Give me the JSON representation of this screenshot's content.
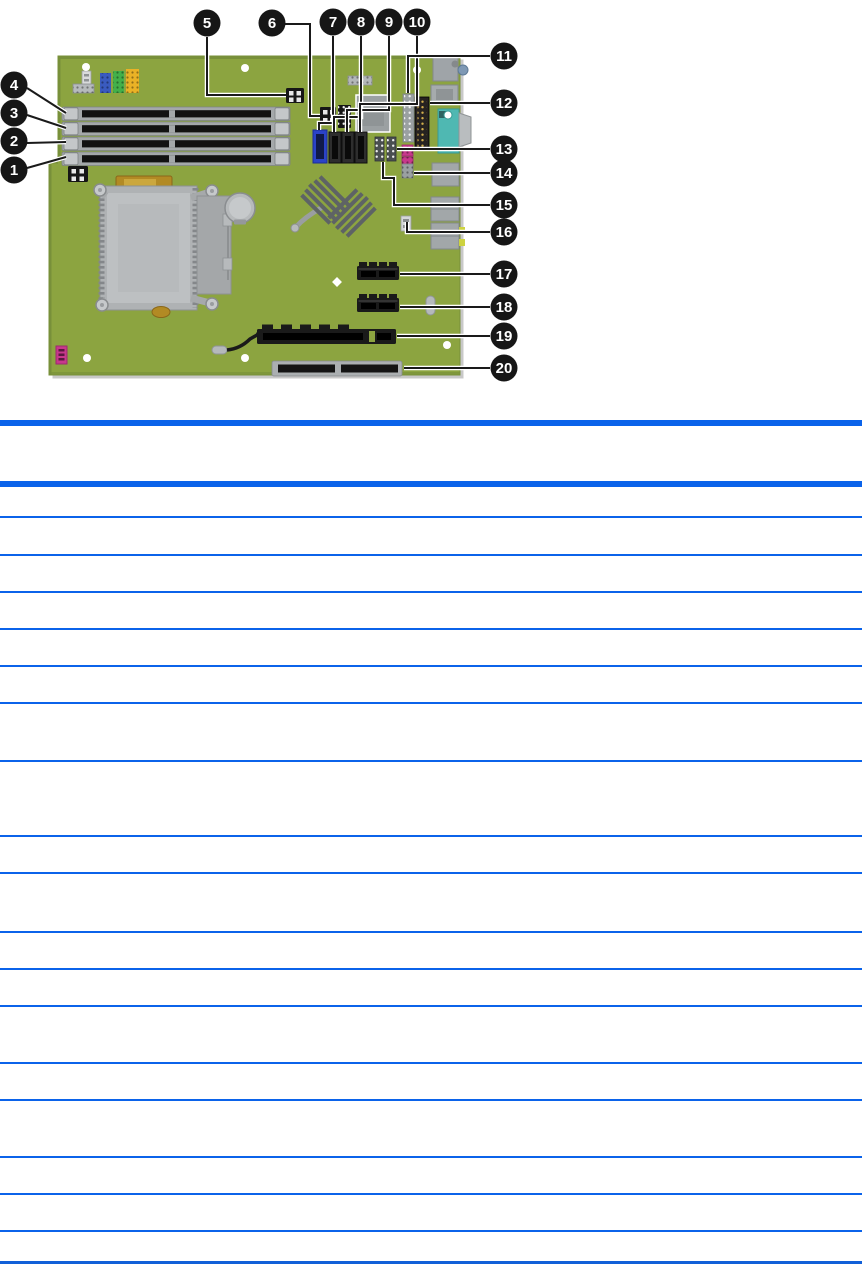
{
  "page": {
    "width": 862,
    "height": 1272,
    "background": "#ffffff"
  },
  "diagram": {
    "title": "system-board-callout-figure",
    "colors": {
      "pcb": "#8CA440",
      "pcb_edge": "#78903A",
      "board_shadow": "#C8C8C8",
      "callout_fill": "#161616",
      "callout_text": "#FFFFFF",
      "leader_line": "#1A1A1A",
      "leader_halo": "#FFFFFF",
      "slot_dark": "#1A1A1A",
      "metal": "#ABAFB1",
      "metal_light": "#C6C9CB",
      "sata_blue": "#2B43C8",
      "header_blue": "#3A5BBF",
      "header_green": "#43B04A",
      "header_yellow": "#EAB226",
      "vga_teal": "#4FB8B2",
      "pink": "#C8388C",
      "gold": "#B28A24"
    },
    "callouts": [
      {
        "label": "1",
        "cx": 14,
        "cy": 170,
        "leader": [
          [
            27,
            168
          ],
          [
            66,
            157
          ]
        ]
      },
      {
        "label": "2",
        "cx": 14,
        "cy": 141,
        "leader": [
          [
            27,
            143
          ],
          [
            66,
            142
          ]
        ]
      },
      {
        "label": "3",
        "cx": 14,
        "cy": 113,
        "leader": [
          [
            27,
            115
          ],
          [
            66,
            128
          ]
        ]
      },
      {
        "label": "4",
        "cx": 14,
        "cy": 85,
        "leader": [
          [
            27,
            88
          ],
          [
            66,
            113
          ]
        ]
      },
      {
        "label": "5",
        "cx": 207,
        "cy": 23,
        "leader": [
          [
            207,
            37
          ],
          [
            207,
            95
          ],
          [
            286,
            95
          ]
        ]
      },
      {
        "label": "6",
        "cx": 272,
        "cy": 23,
        "leader": [
          [
            285,
            24
          ],
          [
            310,
            24
          ],
          [
            310,
            116
          ],
          [
            320,
            116
          ]
        ]
      },
      {
        "label": "7",
        "cx": 333,
        "cy": 22,
        "leader": [
          [
            333,
            36
          ],
          [
            333,
            123
          ],
          [
            319,
            123
          ],
          [
            319,
            130
          ]
        ]
      },
      {
        "label": "8",
        "cx": 361,
        "cy": 22,
        "leader": [
          [
            361,
            36
          ],
          [
            361,
            117
          ],
          [
            334,
            117
          ],
          [
            334,
            132
          ]
        ]
      },
      {
        "label": "9",
        "cx": 389,
        "cy": 22,
        "leader": [
          [
            389,
            36
          ],
          [
            389,
            110
          ],
          [
            347,
            110
          ],
          [
            347,
            132
          ]
        ]
      },
      {
        "label": "10",
        "cx": 417,
        "cy": 22,
        "leader": [
          [
            417,
            36
          ],
          [
            417,
            104
          ],
          [
            360,
            104
          ],
          [
            360,
            132
          ]
        ]
      },
      {
        "label": "11",
        "cx": 504,
        "cy": 56,
        "leader": [
          [
            490,
            56
          ],
          [
            408,
            56
          ],
          [
            408,
            93
          ]
        ]
      },
      {
        "label": "12",
        "cx": 504,
        "cy": 103,
        "leader": [
          [
            490,
            103
          ],
          [
            430,
            103
          ]
        ]
      },
      {
        "label": "13",
        "cx": 504,
        "cy": 149,
        "leader": [
          [
            490,
            149
          ],
          [
            397,
            149
          ]
        ]
      },
      {
        "label": "14",
        "cx": 504,
        "cy": 173,
        "leader": [
          [
            490,
            173
          ],
          [
            414,
            173
          ]
        ]
      },
      {
        "label": "15",
        "cx": 504,
        "cy": 205,
        "leader": [
          [
            490,
            205
          ],
          [
            394,
            205
          ],
          [
            394,
            178
          ],
          [
            383,
            178
          ],
          [
            383,
            162
          ]
        ]
      },
      {
        "label": "16",
        "cx": 504,
        "cy": 232,
        "leader": [
          [
            490,
            232
          ],
          [
            407,
            232
          ],
          [
            407,
            222
          ]
        ]
      },
      {
        "label": "17",
        "cx": 504,
        "cy": 274,
        "leader": [
          [
            490,
            274
          ],
          [
            400,
            274
          ]
        ]
      },
      {
        "label": "18",
        "cx": 504,
        "cy": 307,
        "leader": [
          [
            490,
            307
          ],
          [
            400,
            307
          ]
        ]
      },
      {
        "label": "19",
        "cx": 504,
        "cy": 336,
        "leader": [
          [
            490,
            336
          ],
          [
            397,
            336
          ]
        ]
      },
      {
        "label": "20",
        "cx": 504,
        "cy": 368,
        "leader": [
          [
            490,
            368
          ],
          [
            404,
            368
          ]
        ]
      }
    ]
  },
  "table": {
    "accent_color": "#0B63EA",
    "bottom_rule_color": "#1160D8",
    "visible_text": "",
    "row_heights": [
      29,
      36,
      35,
      35,
      35,
      35,
      56,
      73,
      35,
      57,
      35,
      35,
      55,
      35,
      55,
      35,
      35,
      29
    ]
  }
}
